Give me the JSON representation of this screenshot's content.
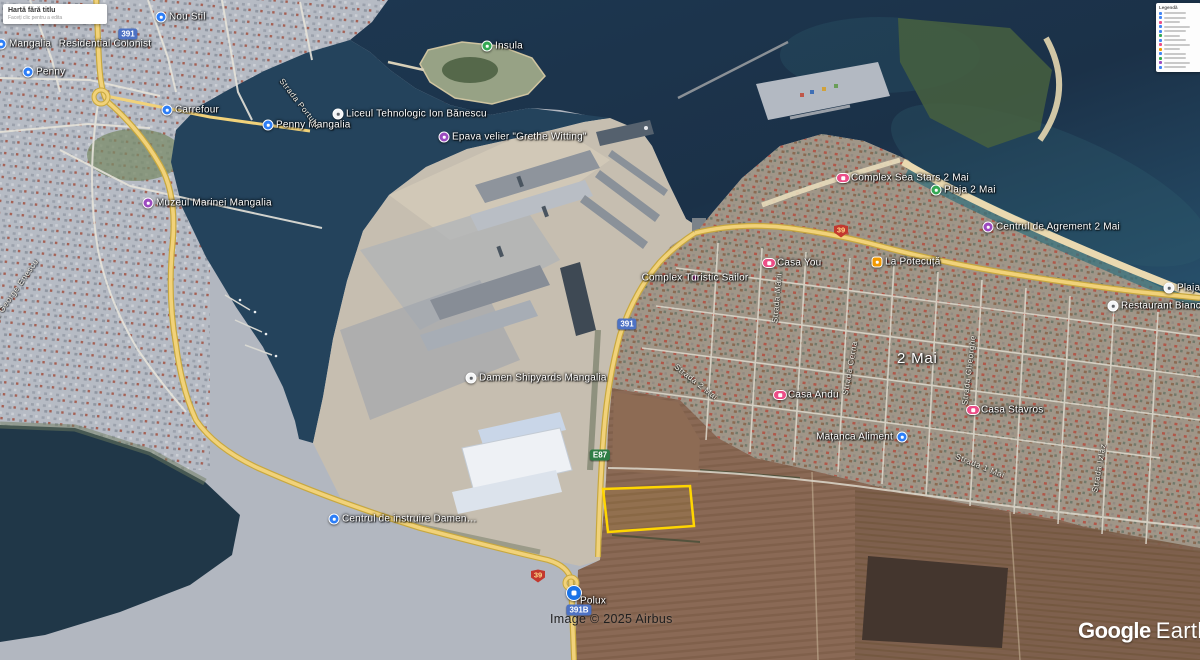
{
  "map_card": {
    "title": "Hartă fără titlu",
    "subtitle": "Faceți clic pentru a edita"
  },
  "legend": {
    "title": "Legendă",
    "item_colors": [
      "#4285f4",
      "#4285f4",
      "#ec4d87",
      "#4285f4",
      "#4285f4",
      "#34a853",
      "#4285f4",
      "#ec4d87",
      "#f29900",
      "#4285f4",
      "#34a853",
      "#9c4bbf",
      "#4285f4"
    ]
  },
  "watermark": {
    "google": "Google",
    "earth": "Earth"
  },
  "attribution": "Image © 2025 Airbus",
  "town_label": "2 Mai",
  "parcel": {
    "color": "#ffd600",
    "fill": "rgba(255,214,0,0.07)",
    "points": "603,489 690,486 694,526 608,532"
  },
  "road_badges": [
    {
      "text": "391",
      "style": "blue",
      "x": 128,
      "y": 34
    },
    {
      "text": "39",
      "style": "shield",
      "x": 841,
      "y": 231
    },
    {
      "text": "391",
      "style": "blue",
      "x": 627,
      "y": 324
    },
    {
      "text": "E87",
      "style": "green",
      "x": 600,
      "y": 455
    },
    {
      "text": "39",
      "style": "shield",
      "x": 538,
      "y": 576
    },
    {
      "text": "391B",
      "style": "blue",
      "x": 579,
      "y": 610
    }
  ],
  "markers": [
    {
      "label": "Mangalia",
      "type": "shop",
      "x": 1,
      "y": 44
    },
    {
      "label": "Residential Colonist",
      "type": "plain",
      "x": 105,
      "y": 44
    },
    {
      "label": "Nou Stil",
      "type": "shop",
      "x": 161,
      "y": 17
    },
    {
      "label": "Penny",
      "type": "shop",
      "x": 28,
      "y": 72
    },
    {
      "label": "Carrefour",
      "type": "shop",
      "x": 167,
      "y": 110
    },
    {
      "label": "Penny Mangalia",
      "type": "shop",
      "x": 268,
      "y": 125
    },
    {
      "label": "Liceul Tehnologic Ion Bănescu",
      "type": "school",
      "x": 338,
      "y": 114
    },
    {
      "label": "Insula",
      "type": "park",
      "x": 487,
      "y": 46
    },
    {
      "label": "Epava velier \"Grethe Witting\"",
      "type": "museum",
      "x": 444,
      "y": 137
    },
    {
      "label": "Muzeul Marinei Mangalia",
      "type": "museum",
      "x": 148,
      "y": 203
    },
    {
      "label": "Damen Shipyards Mangalia",
      "type": "anchor",
      "x": 471,
      "y": 378
    },
    {
      "label": "Centrul de instruire Damen…",
      "type": "poi",
      "x": 334,
      "y": 519
    },
    {
      "label": "Polux",
      "type": "lock",
      "x": 574,
      "y": 593,
      "label_pos": "br"
    },
    {
      "label": "Complex Turistic Sailor",
      "type": "dot",
      "x": 695,
      "y": 278,
      "label_pos": "over"
    },
    {
      "label": "Complex Sea Stars 2 Mai",
      "type": "lodging",
      "x": 843,
      "y": 178
    },
    {
      "label": "Plaja 2 Mai",
      "type": "park",
      "x": 936,
      "y": 190
    },
    {
      "label": "Casa You",
      "type": "lodging",
      "x": 769,
      "y": 263
    },
    {
      "label": "La Potecuță",
      "type": "restaurant",
      "x": 877,
      "y": 262
    },
    {
      "label": "Centrul de Agrement 2 Mai",
      "type": "museum",
      "x": 988,
      "y": 227
    },
    {
      "label": "Plaja",
      "type": "beach",
      "x": 1169,
      "y": 288
    },
    {
      "label": "Restaurant Bianca",
      "type": "dining",
      "x": 1113,
      "y": 306
    },
    {
      "label": "Casa Andu",
      "type": "lodging",
      "x": 780,
      "y": 395
    },
    {
      "label": "Casa Stavros",
      "type": "lodging",
      "x": 973,
      "y": 410
    },
    {
      "label": "Mațanca Aliment",
      "type": "shop",
      "x": 902,
      "y": 437,
      "label_pos": "left"
    }
  ],
  "street_labels": [
    {
      "text": "Strada George Enescu",
      "x": 10,
      "y": 298,
      "rot": -55
    },
    {
      "text": "Strada Portului",
      "x": 300,
      "y": 104,
      "rot": 52
    },
    {
      "text": "Strada Mării",
      "x": 777,
      "y": 298,
      "rot": -85
    },
    {
      "text": "Strada Cerna",
      "x": 850,
      "y": 368,
      "rot": -80
    },
    {
      "text": "Strada Gheorghe",
      "x": 969,
      "y": 370,
      "rot": -83
    },
    {
      "text": "Strada 2 Mai",
      "x": 696,
      "y": 382,
      "rot": 38
    },
    {
      "text": "Strada 1 Mai",
      "x": 980,
      "y": 466,
      "rot": 22
    },
    {
      "text": "Strada Izlaz",
      "x": 1099,
      "y": 468,
      "rot": -80
    }
  ]
}
